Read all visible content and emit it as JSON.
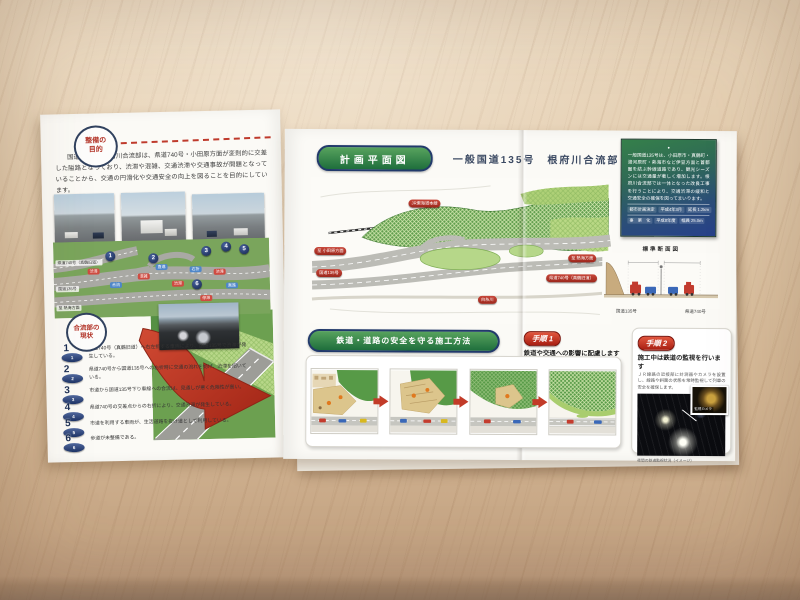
{
  "brochure": {
    "accent_colors": {
      "pill_green": "#2e7d46",
      "label_red": "#b5342c",
      "badge_navy": "#1d3366",
      "arrow_red": "#c23b28"
    },
    "left_page": {
      "purpose_badge": {
        "line1": "整備の",
        "line2": "目的"
      },
      "intro": "国道135号の根府川合流部は、県道740号・小田原方面が変則的に交差した隘路となっており、渋滞や混雑、交通渋滞や交通事故が問題となっていることから、交通の円滑化や交通安全の向上を図ることを目的にしています。",
      "map": {
        "pins": [
          "1",
          "2",
          "3",
          "4",
          "5",
          "6"
        ],
        "flows": [
          {
            "t": "渋滞"
          },
          {
            "t": "混雑"
          },
          {
            "t": "渋滞"
          },
          {
            "t": "渋滞"
          },
          {
            "t": "停滞"
          },
          {
            "t": "合流"
          },
          {
            "t": "直進"
          },
          {
            "t": "右折"
          },
          {
            "t": "直進"
          }
        ],
        "road_labels": [
          "県道740号（真鶴旧道）",
          "国道135号",
          "至 熱海方面"
        ]
      },
      "current_badge": {
        "line1": "合流部の",
        "line2": "現状"
      },
      "issues": [
        {
          "no": "1",
          "text": "県道740号（真鶴旧道）へ右左折する車両により、国道135号で渋滞が発生している。"
        },
        {
          "no": "2",
          "text": "県道740号から国道135号への右折時に交通の流れを妨げ、渋滞を招いている。"
        },
        {
          "no": "3",
          "text": "市道から国道135号下り車線への合流は、見通しが悪く危険性が高い。"
        },
        {
          "no": "4",
          "text": "県道740号の交差点からの右折により、交通渋滞が発生している。"
        },
        {
          "no": "5",
          "text": "市道を利用する車両が、生活道路を抜け道として利用している。"
        },
        {
          "no": "6",
          "text": "歩道が未整備である。"
        }
      ]
    },
    "right_page": {
      "plan_header": "計画平面図",
      "plan_title": "一般国道135号　根府川合流部",
      "plan_labels": {
        "rail": "JR東海道本線",
        "to_odawara": "至 小田原方面",
        "route135": "国道135号",
        "to_atami": "至 熱海方面",
        "pref740": "県道740号（真鶴旧道）",
        "river": "白糸川"
      },
      "info_box": {
        "dot": "●",
        "text": "一般国道135号は、小田原市・真鶴町・湯河原町・熱海市など伊豆方面と首都圏を結ぶ幹線道路であり、観光シーズンには交通量が著しく増加します。根府川合流部では一体となった改良工事を行うことにより、交通渋滞の緩和と交通安全の確保を図ってまいります。",
        "rows": [
          {
            "label": "都市計画決定",
            "c1": "平成4年3月",
            "c2": "延長 1.2km"
          },
          {
            "label": "事　業　化",
            "c1": "平成8年度",
            "c2": "幅員 25.0m"
          }
        ]
      },
      "cross_section": {
        "title": "標準断面図",
        "label_left": "国道135号",
        "label_right": "県道740号"
      },
      "method_header": "鉄道・道路の安全を守る施工方法",
      "step1": {
        "badge": "手順 1",
        "title": "鉄道や交通への影響に配慮します",
        "body": "一般国道135号や東海道本線のすぐそばでの工事となるため、鉄道や交通への影響に配慮しながら、安全・着実に工事を進めます。"
      },
      "step2": {
        "badge": "手順 2",
        "title": "施工中は鉄道の監視を行います",
        "body": "ＪＲ線路の近接部に計測器やカメラを設置し、線路や斜面の状態を常時監視して列車の安全を確保します。",
        "inset_label": "監視カメラ",
        "caption": "夜間の鉄道監視状況（イメージ）"
      }
    }
  }
}
